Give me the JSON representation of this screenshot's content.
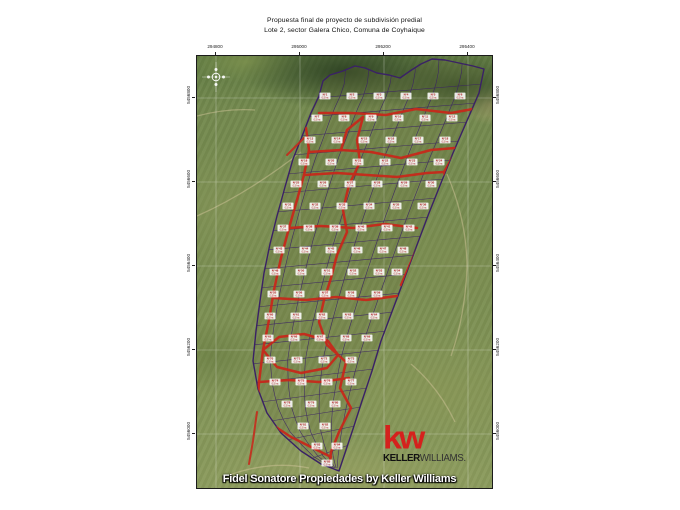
{
  "title": {
    "line1": "Propuesta final de proyecto de subdivisión predial",
    "line2": "Lote 2, sector Galera Chico, Comuna de Coyhaique"
  },
  "map": {
    "caption": "Fidel Sonatore Propiedades by Keller Williams",
    "logo": {
      "mark": "kw",
      "name_bold": "KELLER",
      "name_light": "WILLIAMS",
      "period": "."
    },
    "graticule": {
      "top_labels": [
        {
          "x": 19,
          "text": "294800"
        },
        {
          "x": 103,
          "text": "295000"
        },
        {
          "x": 187,
          "text": "295200"
        },
        {
          "x": 271,
          "text": "295400"
        }
      ],
      "side_labels": [
        {
          "y": 42,
          "text": "5456800"
        },
        {
          "y": 126,
          "text": "5456600"
        },
        {
          "y": 210,
          "text": "5456400"
        },
        {
          "y": 294,
          "text": "5456200"
        },
        {
          "y": 378,
          "text": "5456000"
        }
      ]
    },
    "lots": {
      "prefix": "N°",
      "area_label": "0,5 ha",
      "rows": [
        {
          "y": 40,
          "xs": [
            128,
            155,
            182,
            209,
            236,
            263
          ]
        },
        {
          "y": 62,
          "xs": [
            120,
            147,
            174,
            201,
            228,
            255
          ]
        },
        {
          "y": 84,
          "xs": [
            113,
            140,
            167,
            194,
            221,
            248
          ]
        },
        {
          "y": 106,
          "xs": [
            107,
            134,
            161,
            188,
            215,
            242
          ]
        },
        {
          "y": 128,
          "xs": [
            99,
            126,
            153,
            180,
            207,
            234
          ]
        },
        {
          "y": 150,
          "xs": [
            91,
            118,
            145,
            172,
            199,
            226
          ]
        },
        {
          "y": 172,
          "xs": [
            86,
            112,
            138,
            164,
            190,
            212
          ]
        },
        {
          "y": 194,
          "xs": [
            82,
            108,
            134,
            160,
            186,
            206
          ]
        },
        {
          "y": 216,
          "xs": [
            78,
            104,
            130,
            156,
            182,
            200
          ]
        },
        {
          "y": 238,
          "xs": [
            76,
            102,
            128,
            154,
            180
          ]
        },
        {
          "y": 260,
          "xs": [
            73,
            99,
            125,
            151,
            177
          ]
        },
        {
          "y": 282,
          "xs": [
            71,
            97,
            123,
            149,
            170
          ]
        },
        {
          "y": 304,
          "xs": [
            73,
            100,
            127,
            154
          ]
        },
        {
          "y": 326,
          "xs": [
            78,
            104,
            130,
            154
          ]
        },
        {
          "y": 348,
          "xs": [
            90,
            114,
            138
          ]
        },
        {
          "y": 370,
          "xs": [
            106,
            128
          ]
        },
        {
          "y": 390,
          "xs": [
            120,
            140
          ]
        },
        {
          "y": 407,
          "xs": [
            130
          ]
        }
      ]
    },
    "colors": {
      "road": "#c92619",
      "boundary": "#3a2166",
      "lot_text": "#a61111",
      "kw_red": "#d5211d",
      "trail": "#cfc397"
    }
  }
}
